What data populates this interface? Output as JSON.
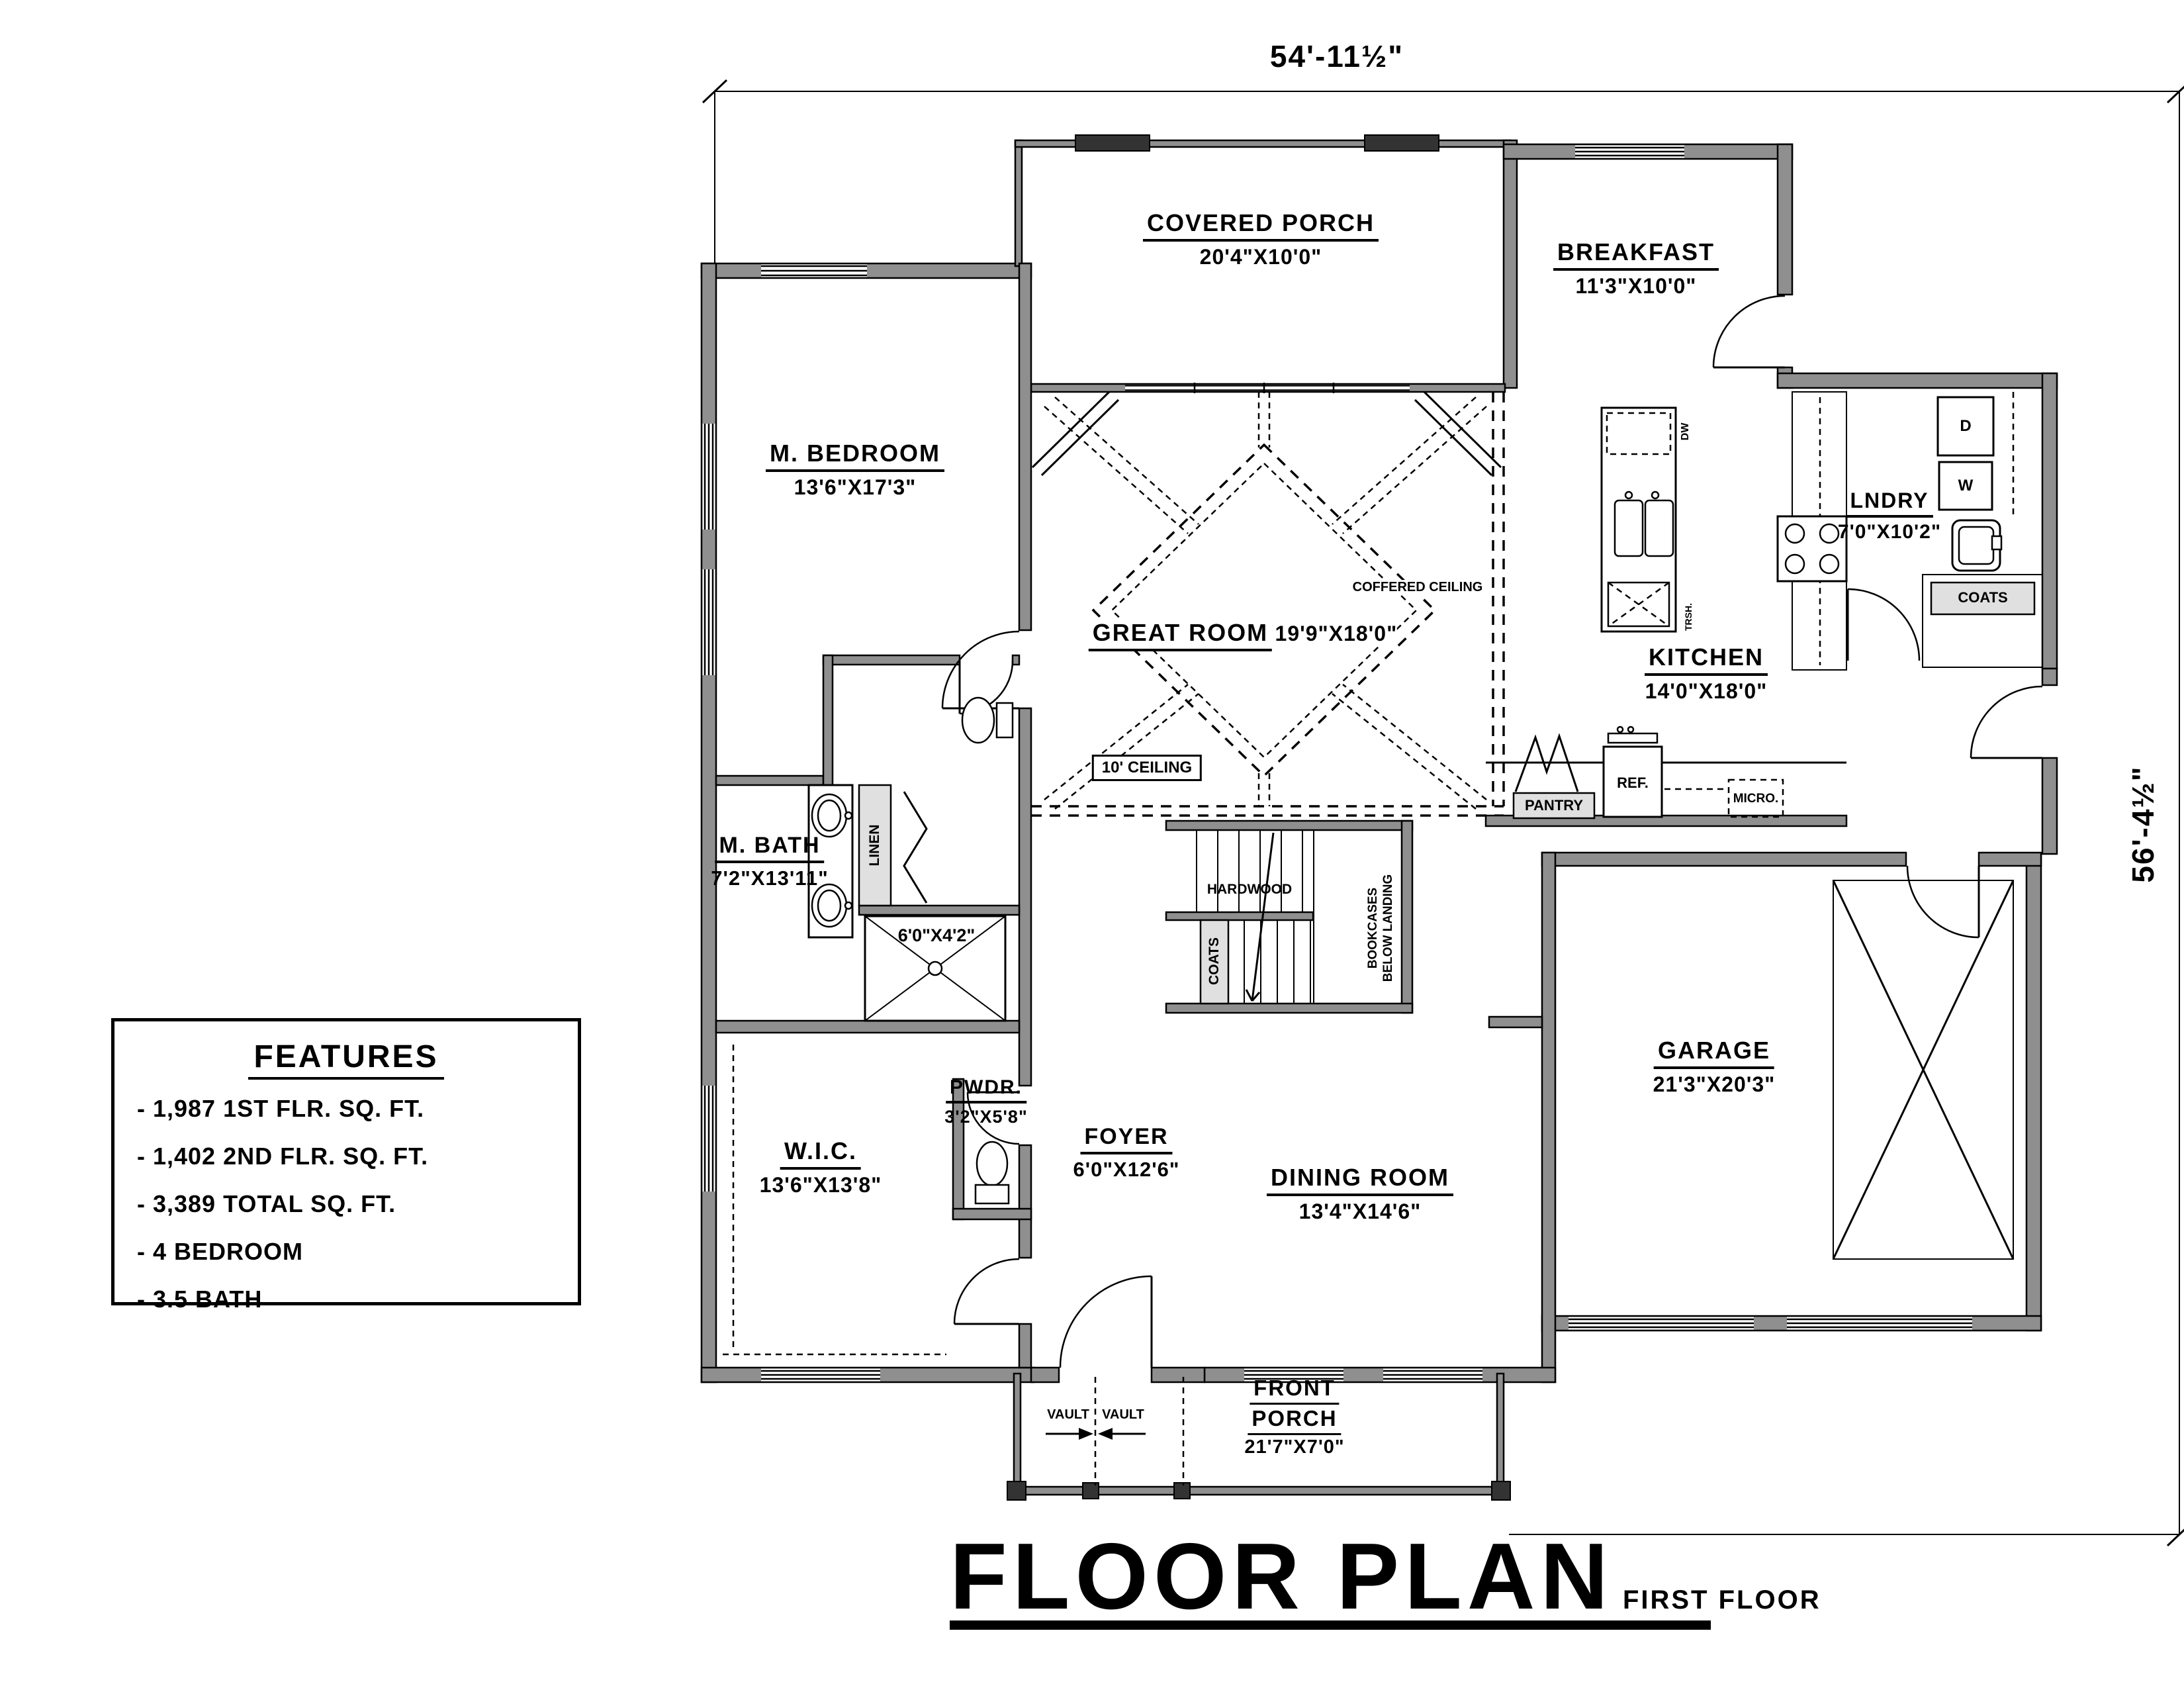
{
  "title": {
    "main": "FLOOR PLAN",
    "sub": "FIRST FLOOR"
  },
  "dims": {
    "top": "54'-11½\"",
    "right": "56'-4½\""
  },
  "features": {
    "heading": "FEATURES",
    "items": [
      "- 1,987 1ST FLR. SQ. FT.",
      "- 1,402 2ND FLR. SQ. FT.",
      "- 3,389 TOTAL SQ. FT.",
      "- 4 BEDROOM",
      "- 3.5 BATH"
    ]
  },
  "rooms": {
    "covered_porch": {
      "name": "COVERED PORCH",
      "size": "20'4\"X10'0\""
    },
    "breakfast": {
      "name": "BREAKFAST",
      "size": "11'3\"X10'0\""
    },
    "m_bedroom": {
      "name": "M. BEDROOM",
      "size": "13'6\"X17'3\""
    },
    "great_room": {
      "name": "GREAT ROOM",
      "size": "19'9\"X18'0\""
    },
    "kitchen": {
      "name": "KITCHEN",
      "size": "14'0\"X18'0\""
    },
    "lndry": {
      "name": "LNDRY",
      "size": "7'0\"X10'2\""
    },
    "m_bath": {
      "name": "M. BATH",
      "size": "7'2\"X13'11\""
    },
    "shower": {
      "size": "6'0\"X4'2\""
    },
    "wic": {
      "name": "W.I.C.",
      "size": "13'6\"X13'8\""
    },
    "pwdr": {
      "name": "PWDR.",
      "size": "3'2\"X5'8\""
    },
    "foyer": {
      "name": "FOYER",
      "size": "6'0\"X12'6\""
    },
    "dining_room": {
      "name": "DINING ROOM",
      "size": "13'4\"X14'6\""
    },
    "garage": {
      "name": "GARAGE",
      "size": "21'3\"X20'3\""
    },
    "front_porch": {
      "name_line1": "FRONT",
      "name_line2": "PORCH",
      "size": "21'7\"X7'0\""
    }
  },
  "annotations": {
    "coffered_ceiling": "COFFERED CEILING",
    "ceiling_height": "10' CEILING",
    "hardwood": "HARDWOOD",
    "bookcases_line1": "BOOKCASES",
    "bookcases_line2": "BELOW LANDING",
    "coats_stairs": "COATS",
    "coats_entry": "COATS",
    "linen": "LINEN",
    "pantry": "PANTRY",
    "ref": "REF.",
    "micro": "MICRO.",
    "dryer": "D",
    "washer": "W",
    "dishwasher": "DW",
    "trash": "TRSH.",
    "vault_left": "VAULT",
    "vault_right": "VAULT"
  }
}
